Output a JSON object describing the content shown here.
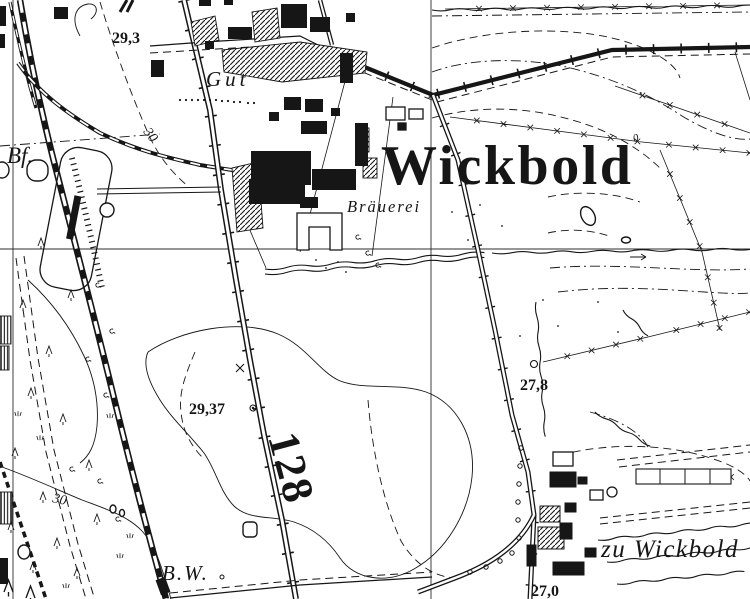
{
  "map": {
    "colors": {
      "ink": "#161616",
      "paper": "#ffffff"
    },
    "labels": {
      "place_main": "Wickbold",
      "hamlet": "zu Wickbold",
      "estate": "Gut",
      "brewery": "Bräuerei",
      "railway_station": "Bf.",
      "railway_keeper": "B.W.",
      "road_number": "128"
    },
    "elevation_points": [
      {
        "value": "29,3"
      },
      {
        "value": "29,37"
      },
      {
        "value": "27,8"
      },
      {
        "value": "27,0"
      }
    ],
    "contour_labels": [
      {
        "value": "30"
      },
      {
        "value": "30"
      },
      {
        "value": "0"
      }
    ]
  }
}
